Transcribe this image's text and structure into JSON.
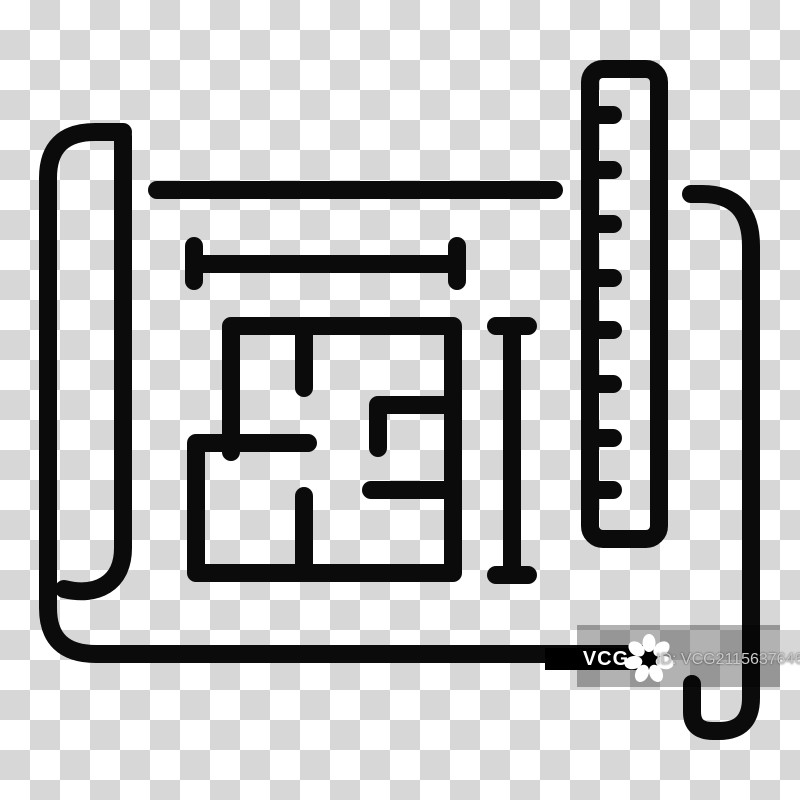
{
  "image": {
    "description": "Black line icon of a rolled blueprint sheet with a floor plan, measurement lines and a ruler, shown on a transparency checkerboard",
    "background": {
      "checker_light": "#ffffff",
      "checker_dark": "#d7d7d7",
      "checker_square_px": 30
    },
    "icon": {
      "stroke_color": "#0b0b0b",
      "stroke_width_px": 18,
      "ruler_tick_count": 8,
      "parts": [
        "paper-roll-left",
        "paper-top-line",
        "horizontal-measure-line",
        "floor-plan",
        "vertical-measure-line",
        "ruler",
        "paper-roll-right",
        "paper-bottom-curl"
      ]
    }
  },
  "watermark": {
    "brand": "VCG",
    "id_label": "ID: VCG211563764681",
    "bar_color": "#000000",
    "brand_text_color": "#ffffff",
    "id_text_color": "#c9c9c9",
    "overlay_color": "rgba(0,0,0,0.30)",
    "logo_color": "#ffffff"
  }
}
